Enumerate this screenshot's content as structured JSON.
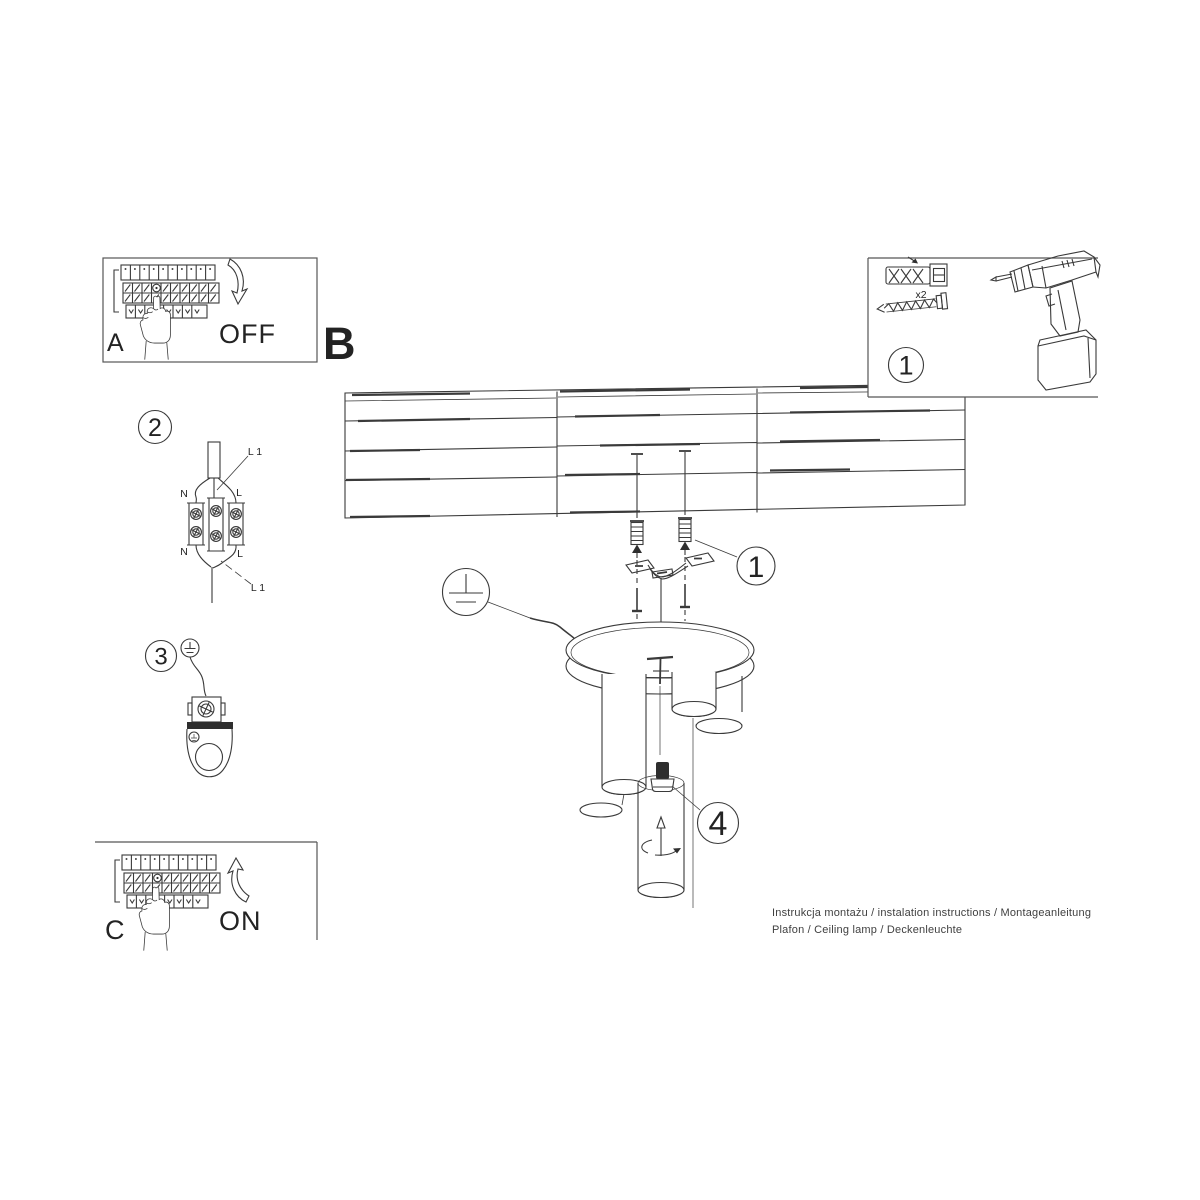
{
  "colors": {
    "background": "#ffffff",
    "line": "#3a3a3a",
    "text": "#232323"
  },
  "panel_a": {
    "label": "A",
    "state": "OFF"
  },
  "overview": {
    "label": "B"
  },
  "tools_panel": {
    "step": "1",
    "anchor_qty": "x2"
  },
  "mounting": {
    "callout": "1"
  },
  "wiring_step": {
    "step": "2",
    "labels": {
      "line_top": "L 1",
      "neutral_in": "N",
      "live_in": "L",
      "neutral_out": "N",
      "live_out": "L",
      "line_bottom": "L 1"
    }
  },
  "earthing_step": {
    "step": "3"
  },
  "bulb_step": {
    "callout": "4"
  },
  "panel_c": {
    "label": "C",
    "state": "ON"
  },
  "footer": {
    "line1": "Instrukcja montażu / instalation instructions / Montageanleitung",
    "line2": "Plafon / Ceiling lamp / Deckenleuchte"
  }
}
